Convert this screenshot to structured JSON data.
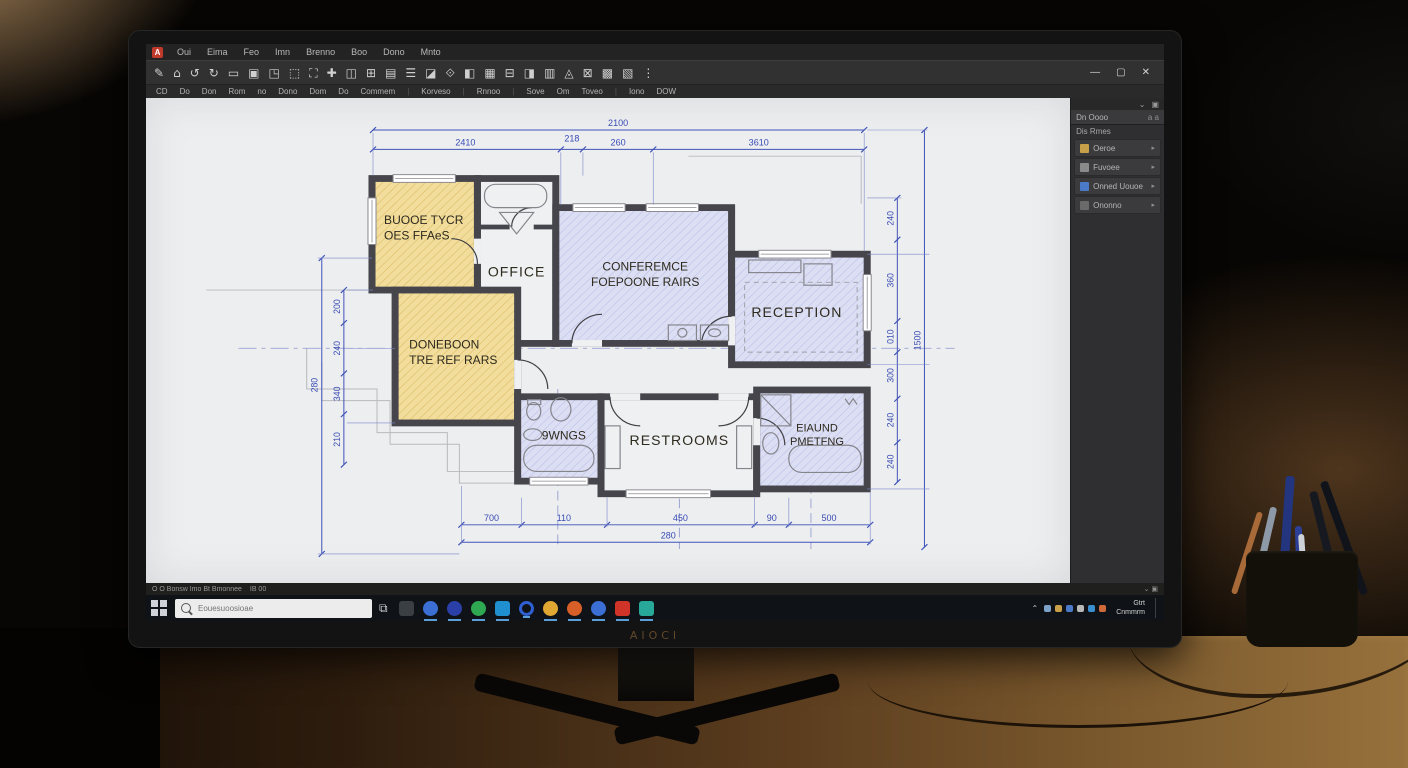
{
  "monitor": {
    "brand": "AIOCI"
  },
  "window": {
    "menu_items": [
      "Oui",
      "Eima",
      "Feo",
      "Imn",
      "Brenno",
      "Boo",
      "Dono",
      "Mnto"
    ],
    "controls": {
      "minimize": "—",
      "maximize": "▢",
      "close": "✕"
    }
  },
  "toolbar": {
    "icons": [
      "✎",
      "⌂",
      "↺",
      "↻",
      "▭",
      "▣",
      "◳",
      "⬚",
      "⛶",
      "✚",
      "◫",
      "⊞",
      "▤",
      "☰",
      "◪",
      "⟐",
      "◧",
      "▦",
      "⊟",
      "◨",
      "▥",
      "◬",
      "⊠",
      "▩",
      "▧",
      "⋮"
    ],
    "labels": [
      "CD",
      "Do",
      "Don",
      "Rom",
      "no",
      "Dono",
      "Dom",
      "Do",
      "Commem",
      "|",
      "Korveso",
      "|",
      "Rnnoo",
      "|",
      "Sove",
      "Om",
      "Toveo",
      "|",
      "Iono",
      "DOW"
    ]
  },
  "side_panel": {
    "mini_icons": [
      "⌄",
      "▣"
    ],
    "title": "Dn Oooo",
    "title_icons": "a  a",
    "subtitle": "Dis Rmes",
    "items": [
      {
        "label": "Oeroe",
        "color": "#c8a04a"
      },
      {
        "label": "Fuvoee",
        "color": "#8a8a8a"
      },
      {
        "label": "Onned Uouoe",
        "color": "#4a7ac8"
      },
      {
        "label": "Ononno",
        "color": "#6a6a6a"
      }
    ]
  },
  "statusbar": {
    "left": "O O   Bonsw   Imo   Bt   Bmonnee",
    "mid": "IB   00",
    "right_icons": "⌄  ▣"
  },
  "taskbar": {
    "search_placeholder": "Eouesuoosioae",
    "apps": [
      {
        "name": "app-1",
        "color": "#3a3f44",
        "square": true,
        "running": false
      },
      {
        "name": "app-2",
        "color": "#3b6fd4",
        "square": false,
        "running": true
      },
      {
        "name": "app-3",
        "color": "#2b3fa8",
        "square": false,
        "running": true
      },
      {
        "name": "app-4",
        "color": "#2fa852",
        "square": false,
        "running": true
      },
      {
        "name": "app-5",
        "color": "#1f8fd0",
        "square": true,
        "running": true
      },
      {
        "name": "app-6",
        "color": "#2f5fd0",
        "square": false,
        "running": true,
        "ring": true
      },
      {
        "name": "app-7",
        "color": "#e0a832",
        "square": false,
        "running": true
      },
      {
        "name": "app-8",
        "color": "#d86028",
        "square": false,
        "running": true
      },
      {
        "name": "app-9",
        "color": "#3b6fd4",
        "square": false,
        "running": true
      },
      {
        "name": "app-10",
        "color": "#d03428",
        "square": true,
        "running": true
      },
      {
        "name": "app-11",
        "color": "#28a898",
        "square": true,
        "running": true
      }
    ],
    "tray_icons": [
      "#7da2c8",
      "#c8a04a",
      "#4a7ac8",
      "#b8b8b8",
      "#3a8fd0",
      "#d06a3a"
    ],
    "tray_chevron": "⌃",
    "clock_line1": "Gtrt",
    "clock_line2": "Cnmmrm"
  },
  "plan": {
    "rooms": {
      "room1": {
        "line1": "BUOOE TYCR",
        "line2": "OES FFAeS"
      },
      "office": {
        "line1": "OFFICE"
      },
      "conference": {
        "line1": "CONFEREMCE",
        "line2": "FOEPOONE RAIRS"
      },
      "reception": {
        "line1": "RECEPTION"
      },
      "room2": {
        "line1": "DONEBOON",
        "line2": "TRE REF RARS"
      },
      "bath": {
        "line1": "9WNGS"
      },
      "restrooms": {
        "line1": "RESTROOMS"
      },
      "laundry": {
        "line1": "EIAUND",
        "line2": "PMETFNG"
      }
    },
    "dims": {
      "top_overall": "2100",
      "top_segments": [
        "2410",
        "218",
        "260",
        "3610"
      ],
      "bottom_segments": [
        "700",
        "110",
        "450",
        "90",
        "500"
      ],
      "bottom_overall": "280",
      "left_segments": [
        "200",
        "240",
        "340",
        "210"
      ],
      "left_overall": "280",
      "right_segments": [
        "240",
        "360",
        "010",
        "300",
        "240",
        "240"
      ],
      "right_overall": "1500"
    }
  },
  "colors": {
    "dimension_blue": "#4053b8",
    "room_yellow": "#f2dd9d",
    "room_lavender": "#dcdef3",
    "wall_gray": "#45454b",
    "taskbar_accent": "#5a9fd8"
  }
}
